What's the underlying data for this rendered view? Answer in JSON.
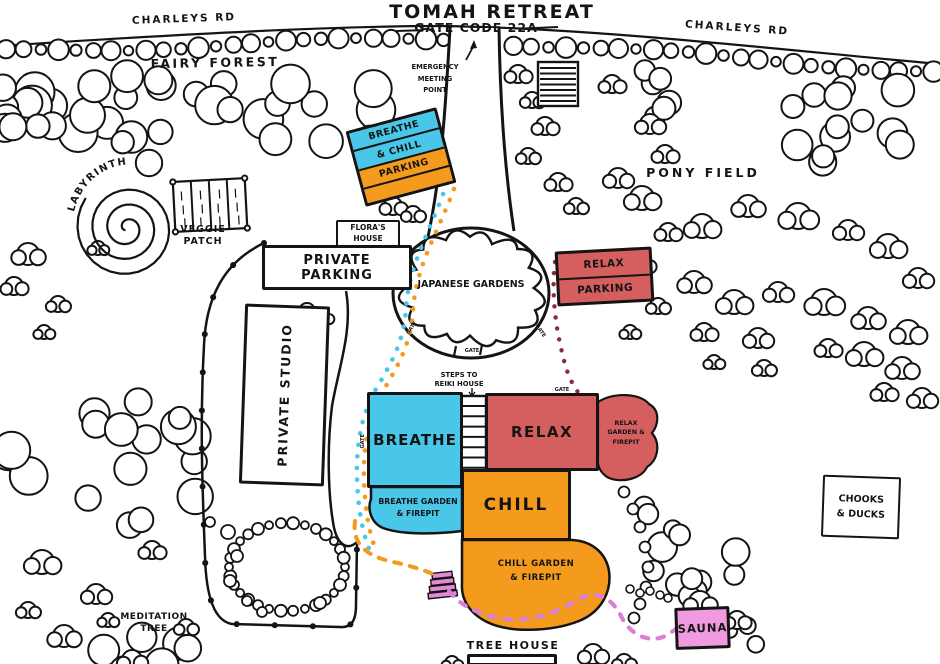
{
  "header": {
    "title": "TOMAH RETREAT",
    "gate_code": "GATE CODE 22A"
  },
  "roads": {
    "charleys_rd_left": "CHARLEYS RD",
    "charleys_rd_right": "CHARLEYS RD"
  },
  "areas": {
    "fairy_forest": "FAIRY FOREST",
    "pony_field": "PONY FIELD",
    "labyrinth": "LABYRINTH",
    "veggie_patch": "VEGGIE\nPATCH",
    "japanese_gardens": "JAPANESE GARDENS",
    "meditation_tree": "MEDITATION\nTREE",
    "emergency_meeting_point": "EMERGENCY\nMEETING\nPOINT",
    "chooks_ducks": "CHOOKS\n& DUCKS",
    "tree_house": "TREE HOUSE"
  },
  "buildings": {
    "breathe_chill_parking_l1": "BREATHE",
    "breathe_chill_parking_l2": "& CHILL",
    "breathe_chill_parking_l3": "PARKING",
    "floras_house": "FLORA'S\nHOUSE",
    "private_parking": "PRIVATE PARKING",
    "relax_parking_l1": "RELAX",
    "relax_parking_l2": "PARKING",
    "private_studio": "PRIVATE STUDIO",
    "breathe": "BREATHE",
    "relax": "RELAX",
    "chill": "CHILL",
    "sauna": "SAUNA",
    "steps_to_reiki": "STEPS TO\nREIKI HOUSE"
  },
  "gardens": {
    "relax_garden": "RELAX\nGARDEN &\nFIREPIT",
    "breathe_garden": "BREATHE GARDEN\n& FIREPIT",
    "chill_garden": "CHILL GARDEN\n& FIREPIT"
  },
  "labels": {
    "gate": "GATE"
  },
  "colors": {
    "cyan": "#49C7E9",
    "orange": "#F49A1D",
    "red": "#D55F5F",
    "pink": "#F09BDF",
    "pink_steps": "#E18BD7",
    "maroon": "#8F2744",
    "trail_pink": "#DB7ED6",
    "ink": "#141414"
  }
}
